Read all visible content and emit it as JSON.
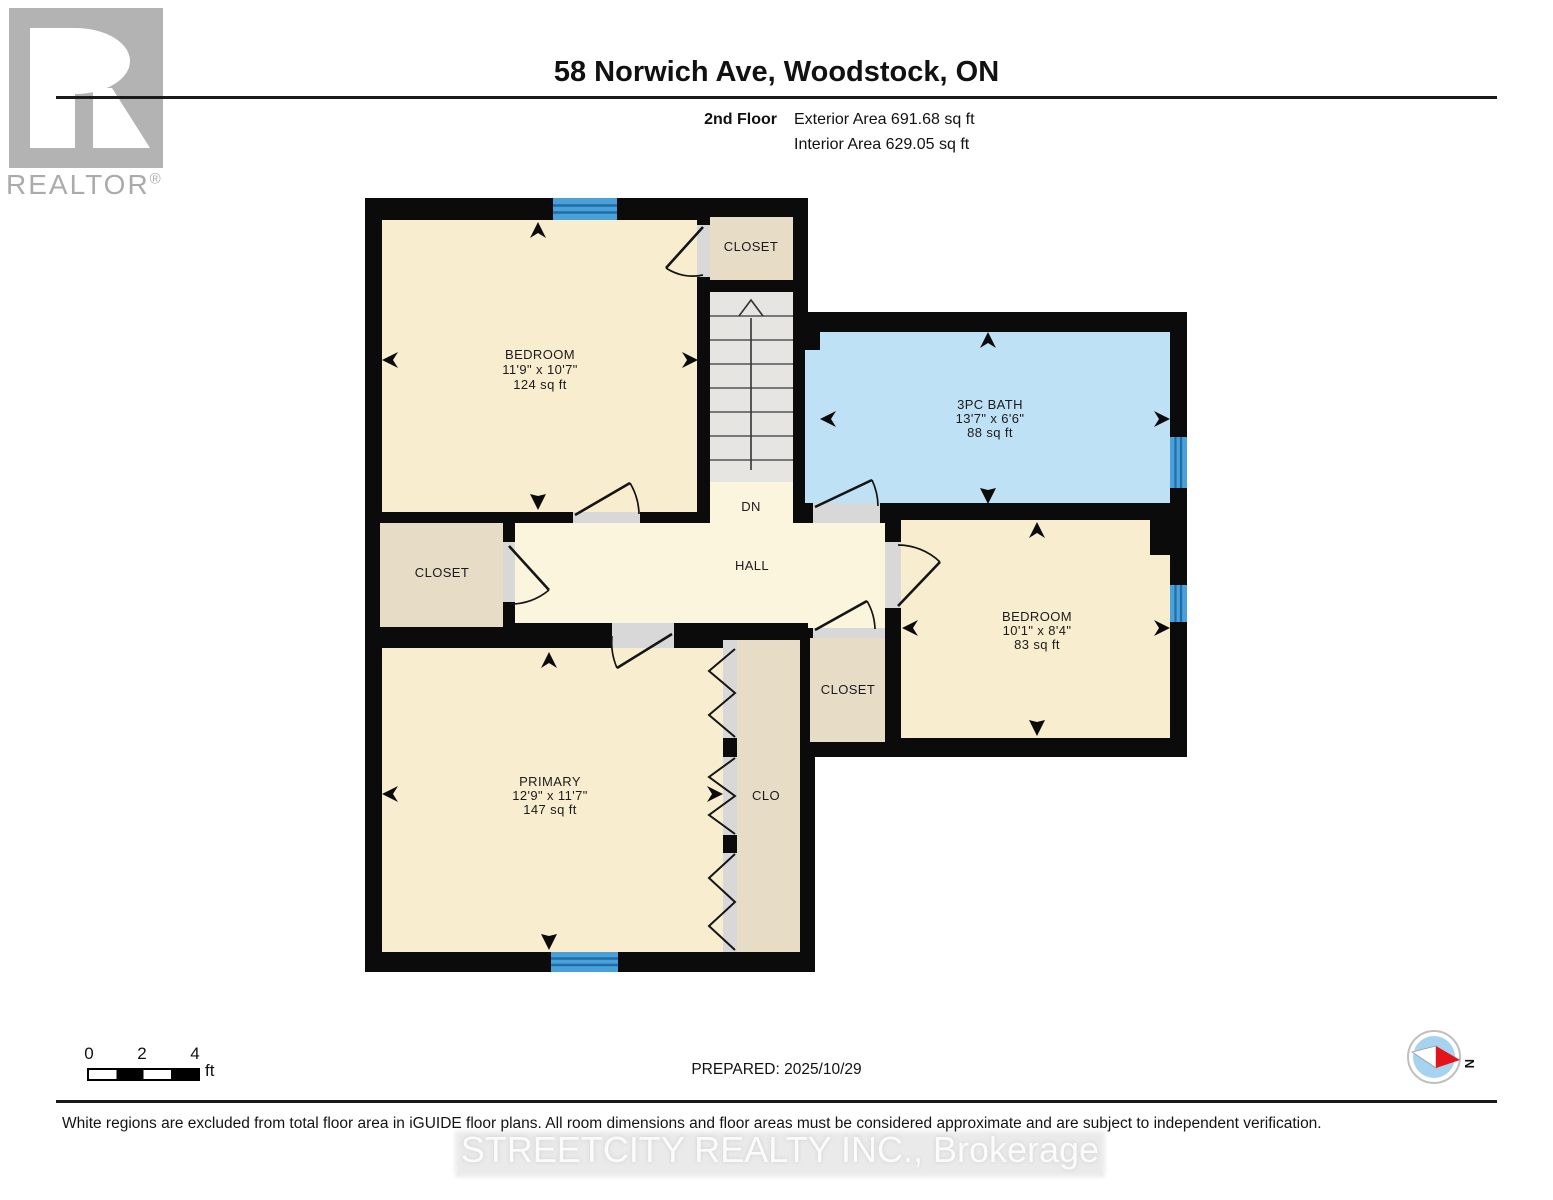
{
  "header": {
    "title": "58 Norwich Ave, Woodstock, ON",
    "floor_label": "2nd Floor",
    "exterior_area": "Exterior Area 691.68 sq ft",
    "interior_area": "Interior Area 629.05 sq ft"
  },
  "logo": {
    "brand": "REALTOR",
    "registered": "®"
  },
  "plan": {
    "rooms": [
      {
        "name": "BEDROOM",
        "dims": "11'9\" x 10'7\"",
        "area": "124 sq ft"
      },
      {
        "name": "3PC BATH",
        "dims": "13'7\" x 6'6\"",
        "area": "88 sq ft"
      },
      {
        "name": "BEDROOM",
        "dims": "10'1\" x 8'4\"",
        "area": "83 sq ft"
      },
      {
        "name": "PRIMARY",
        "dims": "12'9\" x 11'7\"",
        "area": "147 sq ft"
      }
    ],
    "labels": {
      "closet_top": "CLOSET",
      "closet_left": "CLOSET",
      "closet_right": "CLOSET",
      "clo": "CLO",
      "hall": "HALL",
      "down": "DN"
    }
  },
  "footer": {
    "scale": {
      "tick0": "0",
      "tick2": "2",
      "tick4": "4",
      "unit": "ft"
    },
    "prepared": "PREPARED: 2025/10/29",
    "compass_north": "N",
    "disclaimer": "White regions are excluded from total floor area in iGUIDE floor plans. All room dimensions and floor areas must be considered approximate and are subject to independent verification.",
    "watermark": "STREETCITY REALTY INC., Brokerage"
  },
  "colors": {
    "wall": "#0b0b0b",
    "room_cream": "#F8EDCF",
    "hall_cream": "#FCF5DE",
    "closet_tan": "#E7DDC7",
    "bath_blue": "#BFE1F6",
    "window_blue": "#4AA0D8",
    "window_stripe": "#1E6EA7",
    "stair_gray": "#E6E5E2",
    "threshold_gray": "#D8D8D8"
  }
}
